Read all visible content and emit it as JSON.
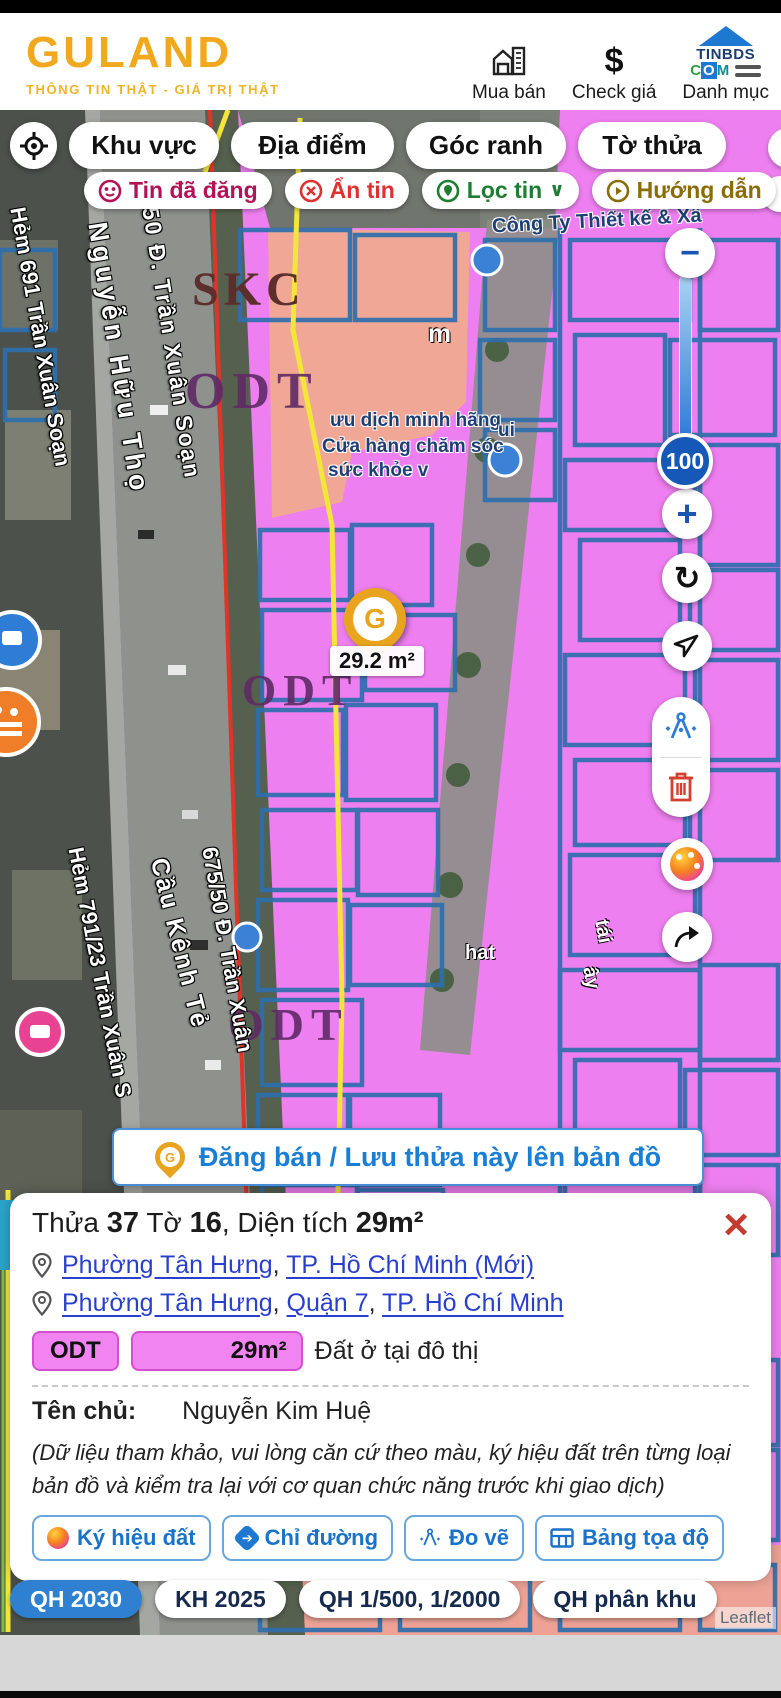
{
  "header": {
    "logo": "GULAND",
    "tagline": "THÔNG TIN THẬT - GIÁ TRỊ THẬT",
    "nav_mua_ban": "Mua bán",
    "nav_check_gia": "Check giá",
    "nav_danh_muc": "Danh mục",
    "tinbds_top": "TINBDS",
    "tinbds_c": "C",
    "tinbds_o": "O",
    "tinbds_m": "M"
  },
  "icons": {
    "dollar": "$",
    "minus": "−",
    "plus": "+",
    "refresh": "↻",
    "close": "×",
    "chevron_down": "∨",
    "play": "▸",
    "arrow": "➔",
    "g": "G"
  },
  "filters": {
    "primary": [
      "Khu vực",
      "Địa điểm",
      "Góc ranh",
      "Tờ thửa"
    ],
    "secondary": [
      {
        "label": "Tin đã đăng"
      },
      {
        "label": "Ẩn tin"
      },
      {
        "label": "Lọc tin"
      },
      {
        "label": "Hướng dẫn"
      }
    ]
  },
  "map": {
    "zones": {
      "skc": "SKC",
      "odt1": "ODT",
      "odt2": "ODT",
      "odt3": "ODT"
    },
    "streets": [
      "Hẻm 691 Trần Xuân Soạn",
      "Nguyễn Hữu Thọ",
      "50 Đ. Trần Xuân Soạn",
      "Hẻm 791/23 Trần Xuân S",
      "Cầu Kênh Tẻ",
      "675/50 Đ. Trần Xuân"
    ],
    "pois": [
      "Công Ty Thiết kế & Xâ",
      "ưu dịch minh hãng",
      "Cửa hàng chăm sóc",
      "sức khỏe v"
    ],
    "fragments": [
      "m",
      "ui",
      "hat",
      "tái",
      "ây"
    ],
    "marker_label": "29.2 m²",
    "zoom_badge": "100",
    "attribution": "Leaflet"
  },
  "banner": {
    "label": "Đăng bán / Lưu thửa này lên bản đồ"
  },
  "panel": {
    "title": {
      "t1": "Thửa ",
      "v1": "37",
      "t2": " Tờ ",
      "v2": "16",
      "t3": ", Diện tích ",
      "v3": "29m²"
    },
    "sep": ", ",
    "location_new": [
      "Phường Tân Hưng",
      "TP. Hồ Chí Minh (Mới)"
    ],
    "location_old": [
      "Phường Tân Hưng",
      "Quận 7",
      "TP. Hồ Chí Minh"
    ],
    "land": {
      "code": "ODT",
      "area": "29m²",
      "name": "Đất ở tại đô thị"
    },
    "owner_label": "Tên chủ:",
    "owner_name": "Nguyễn Kim Huệ",
    "disclaimer": "(Dữ liệu tham khảo, vui lòng căn cứ theo màu, ký hiệu đất trên từng loại bản đồ và kiểm tra lại với cơ quan chức năng trước khi giao dịch)",
    "actions": [
      "Ký hiệu đất",
      "Chỉ đường",
      "Đo vẽ",
      "Bảng tọa độ"
    ]
  },
  "layers": [
    {
      "label": "QH 2030",
      "active": true
    },
    {
      "label": "KH 2025",
      "active": false
    },
    {
      "label": "QH 1/500, 1/2000",
      "active": false
    },
    {
      "label": "QH phân khu",
      "active": false
    }
  ]
}
